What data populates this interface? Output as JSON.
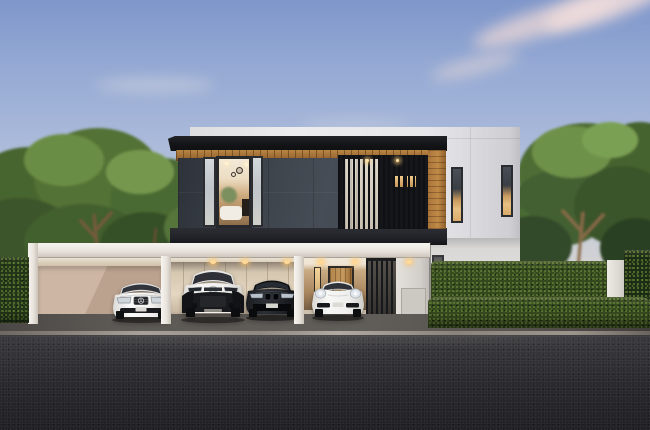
{
  "meta": {
    "title": "Dusk rendering of a modern two-storey house with carport",
    "domain_note": "architectural visualization, no visible UI text",
    "time_of_day": "dusk"
  },
  "scene": {
    "sky": {
      "top_color": "#7e96ca",
      "horizon_color": "#e3dcd2",
      "clouds": "soft pink streaks in upper right"
    },
    "building": {
      "storeys": 2,
      "rear_block": {
        "label": "white rear block",
        "color": "#e7e7ea",
        "windows": [
          "narrow lit slit window left",
          "narrow lit slit window right"
        ]
      },
      "front_block": {
        "label": "charcoal stone upper block",
        "facade_color": "#3f454d",
        "roof_color": "#141518",
        "soffit_material": "wood",
        "soffit_color": "#a9743e",
        "left_window": "warm lit living room with pendant lamps, plant and white sofa",
        "balcony": "dark vertical slat screen with light curtains and two lit openings",
        "side_wood_column_color": "#b3803f"
      },
      "ground_floor": {
        "carport_color": "#efece7",
        "carport_posts": 3,
        "garage_wall_color": "#e4d6c0",
        "entrance": "recessed warm lobby with wooden plank door and lit sidelight",
        "gate": "dark vertical slat gate",
        "downlights": "warm recessed ceiling spots"
      }
    },
    "vehicles": [
      {
        "name": "mercedes-sedan",
        "type": "white luxury sedan with three-pointed-star grille",
        "body_color": "#f3f2f0"
      },
      {
        "name": "toyota-chr",
        "type": "white compact crossover with black lower cladding",
        "body_color": "#f4f3f1"
      },
      {
        "name": "bmw-sedan",
        "type": "black sports sedan with twin kidney grille",
        "body_color": "#16181c"
      },
      {
        "name": "porsche-911",
        "type": "white sports car with round headlights",
        "body_color": "#f0f0ef"
      }
    ],
    "landscape": {
      "left": "dense green deciduous trees behind dark clipped hedge",
      "right": "large tree over double-tier clipped hedge with white pillar",
      "hedge_color": "#36491f",
      "dark_hedge_color": "#243619",
      "side_wall_color": "#c3ad9a",
      "pillar_color": "#eeebe6"
    },
    "ground": {
      "driveway_color": "#5d5a56",
      "curb_color": "#a9a199",
      "road_color": "#2a2a2e"
    }
  }
}
